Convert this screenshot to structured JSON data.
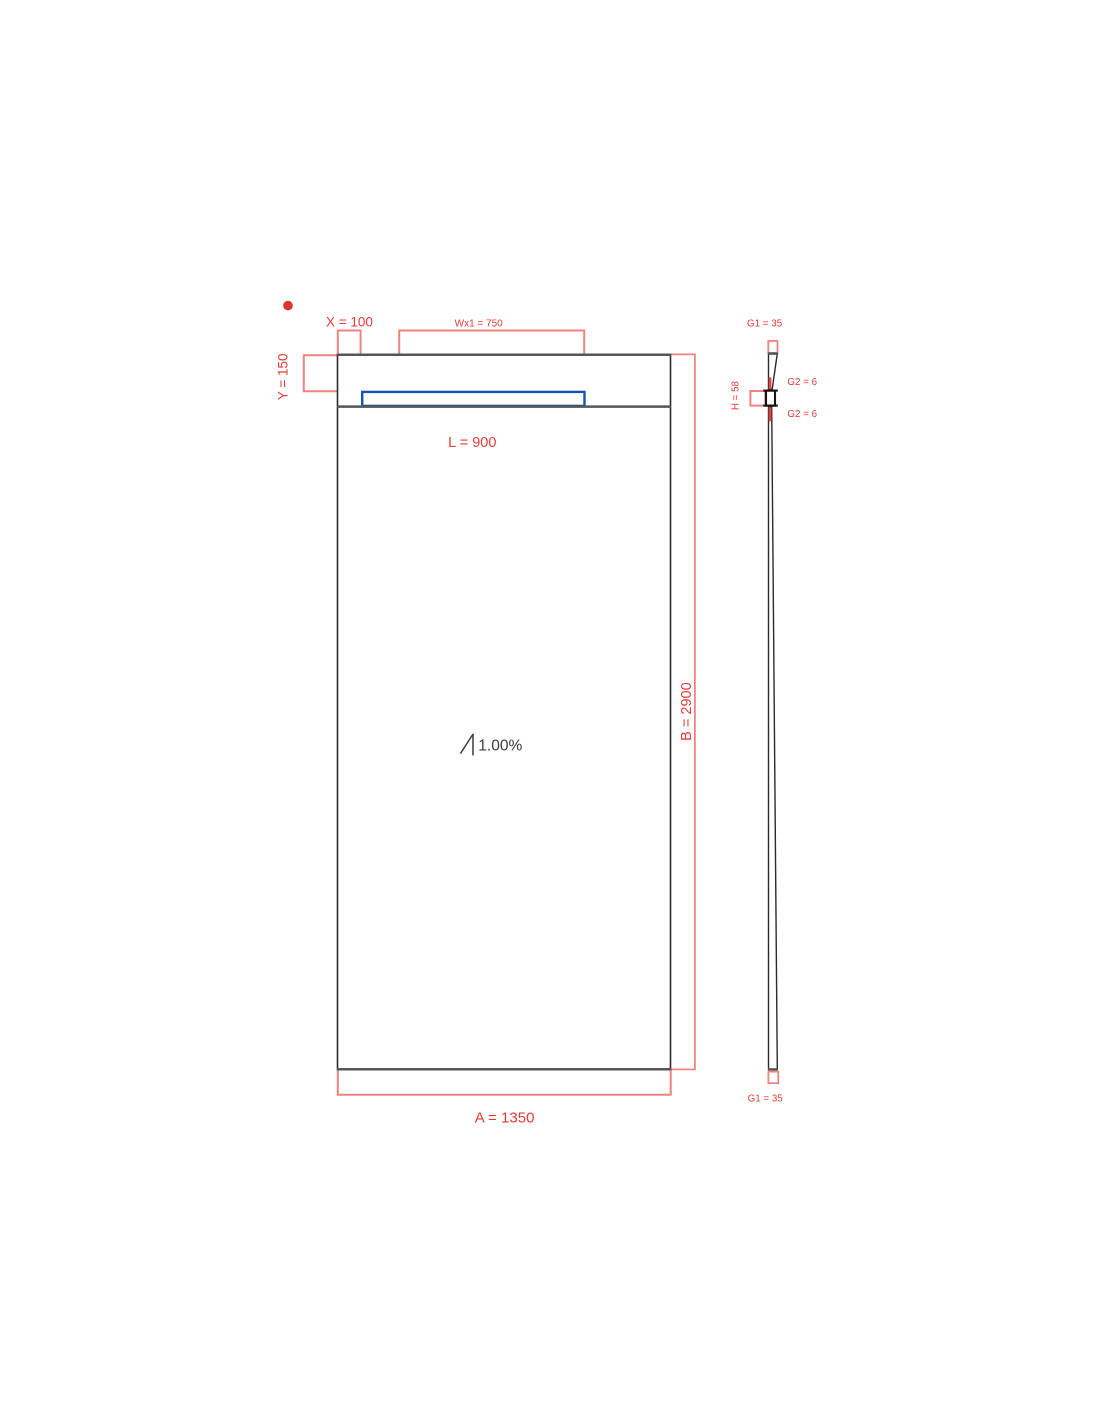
{
  "plan_view": {
    "dim_x_label": "X = 100",
    "dim_wx1_label": "Wx1 = 750",
    "dim_y_label": "Y = 150",
    "dim_l_label": "L = 900",
    "dim_b_label": "B = 2900",
    "dim_a_label": "A = 1350",
    "slope_label": "1.00%"
  },
  "side_view": {
    "dim_g1_top_label": "G1 = 35",
    "dim_g2_upper_label": "G2 = 6",
    "dim_g2_lower_label": "G2 = 6",
    "dim_h_label": "H = 58",
    "dim_g1_bottom_label": "G1 = 35"
  },
  "values": {
    "A": 1350,
    "B": 2900,
    "L": 900,
    "X": 100,
    "Y": 150,
    "Wx1": 750,
    "G1": 35,
    "G2": 6,
    "H": 58,
    "slope_percent": 1.0
  },
  "colors": {
    "dimline": "#f0837f",
    "dimstrong": "#e5413d",
    "dimtext": "#e23c38",
    "dot": "#d6362f",
    "blue": "#1254b0",
    "edgedark": "#2b2b2d",
    "edgegray": "#55565a",
    "slopetext": "#3b3b3b"
  }
}
